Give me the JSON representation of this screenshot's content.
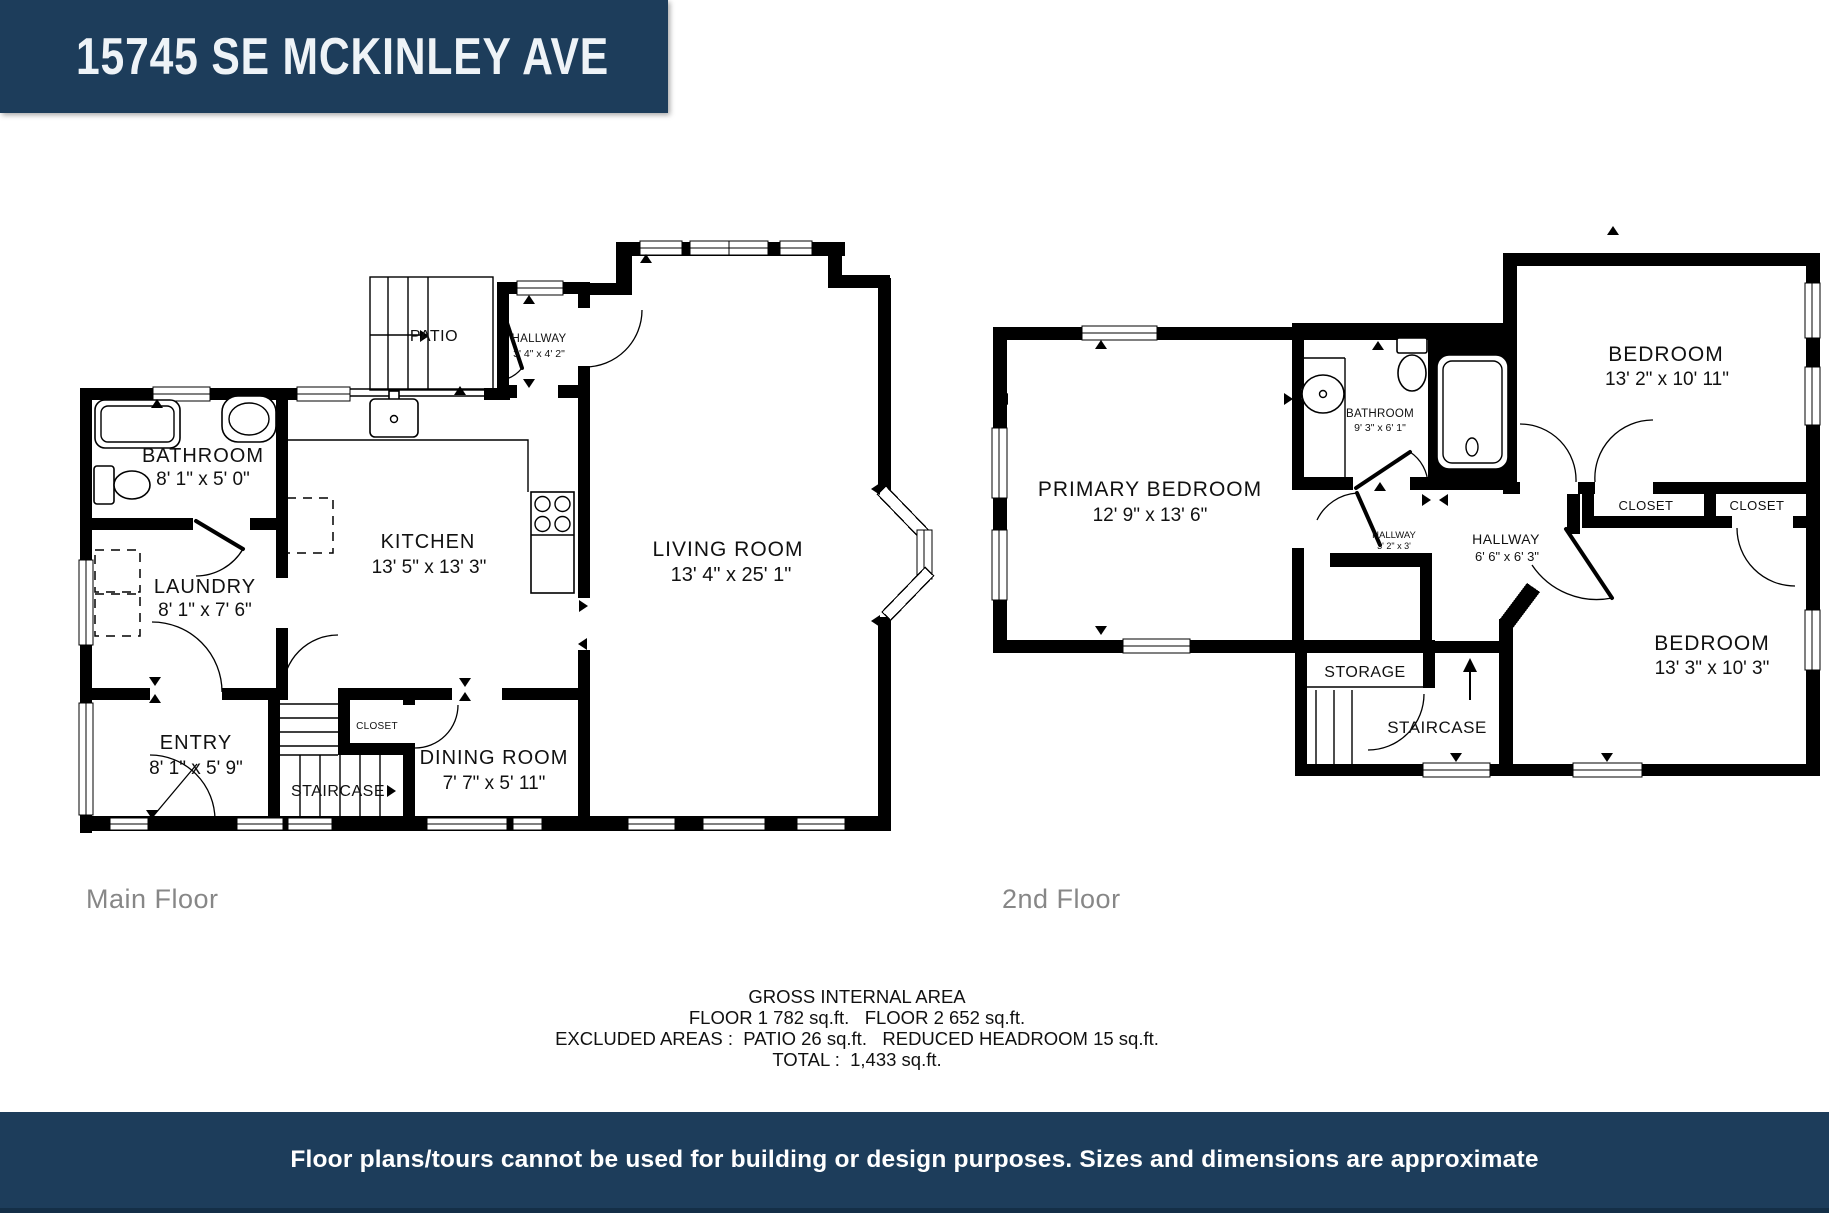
{
  "title_banner": {
    "address": "15745 SE MCKINLEY AVE"
  },
  "floors": [
    {
      "label": "Main Floor",
      "rooms": [
        {
          "name": "BATHROOM",
          "dims": "8' 1\" x 5' 0\""
        },
        {
          "name": "LAUNDRY",
          "dims": "8' 1\" x 7' 6\""
        },
        {
          "name": "ENTRY",
          "dims": "8' 1\" x 5' 9\""
        },
        {
          "name": "STAIRCASE",
          "dims": ""
        },
        {
          "name": "CLOSET",
          "dims": ""
        },
        {
          "name": "DINING ROOM",
          "dims": "7' 7\" x 5' 11\""
        },
        {
          "name": "KITCHEN",
          "dims": "13' 5\" x 13' 3\""
        },
        {
          "name": "PATIO",
          "dims": ""
        },
        {
          "name": "HALLWAY",
          "dims": "3' 4\" x 4' 2\""
        },
        {
          "name": "LIVING ROOM",
          "dims": "13' 4\" x 25' 1\""
        }
      ]
    },
    {
      "label": "2nd Floor",
      "rooms": [
        {
          "name": "PRIMARY BEDROOM",
          "dims": "12' 9\" x 13' 6\""
        },
        {
          "name": "BATHROOM",
          "dims": "9' 3\" x 6' 1\""
        },
        {
          "name": "BEDROOM",
          "dims": "13' 2\" x 10' 11\""
        },
        {
          "name": "CLOSET",
          "dims": ""
        },
        {
          "name": "CLOSET",
          "dims": ""
        },
        {
          "name": "HALLWAY",
          "dims": "3' 2\" x 3'"
        },
        {
          "name": "HALLWAY",
          "dims": "6' 6\" x 6' 3\""
        },
        {
          "name": "STORAGE",
          "dims": ""
        },
        {
          "name": "STAIRCASE",
          "dims": ""
        },
        {
          "name": "BEDROOM",
          "dims": "13' 3\" x 10' 3\""
        }
      ]
    }
  ],
  "area_summary": {
    "title": "GROSS INTERNAL AREA",
    "floors_line": "FLOOR 1 782 sq.ft.   FLOOR 2 652 sq.ft.",
    "excluded_line": "EXCLUDED AREAS :  PATIO 26 sq.ft.   REDUCED HEADROOM 15 sq.ft.",
    "total_line": "TOTAL :  1,433 sq.ft."
  },
  "disclaimer": "Floor plans/tours cannot be used for building or design purposes. Sizes and dimensions are approximate",
  "colors": {
    "banner_navy": "#1d3d5b",
    "wall_black": "#000000",
    "label_gray": "#878787"
  }
}
